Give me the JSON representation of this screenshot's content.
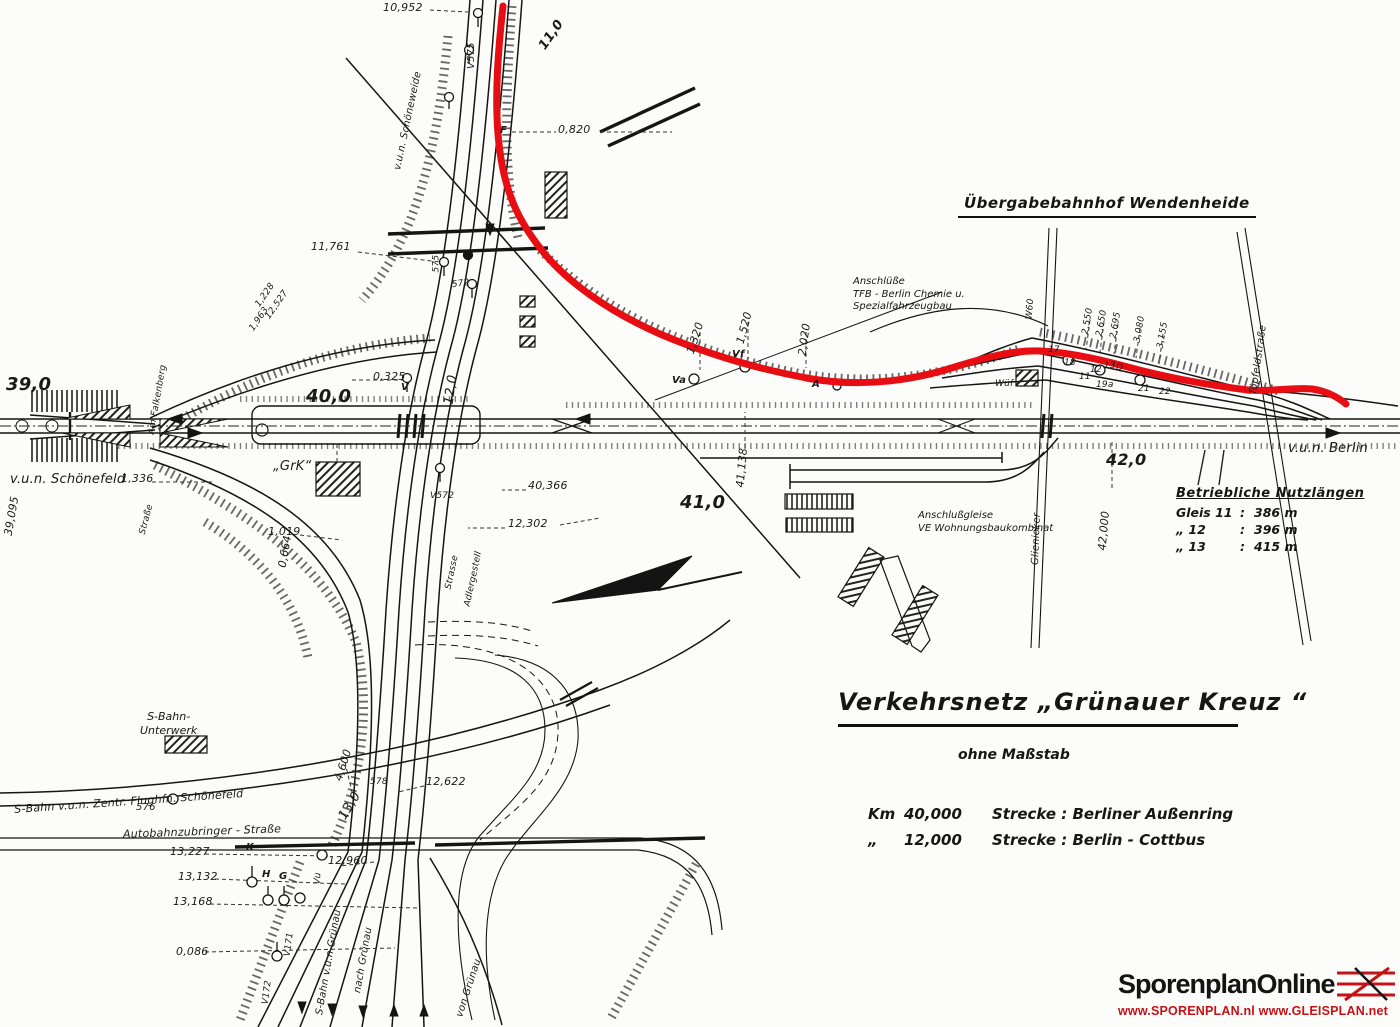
{
  "colors": {
    "ink": "#1a1a1a",
    "route_red": "#e70d12",
    "logo_red": "#c41217",
    "paper": "#fcfcfa"
  },
  "header": {
    "station": "Übergabebahnhof  Wendenheide"
  },
  "title_block": {
    "title": "Verkehrsnetz  „Grünauer  Kreuz “",
    "subtitle": "ohne Maßstab",
    "rows": [
      {
        "c1": "Km",
        "c2": "40,000",
        "c3": "Strecke :  Berliner Außenring"
      },
      {
        "c1": "„",
        "c2": "12,000",
        "c3": "Strecke :  Berlin - Cottbus"
      }
    ]
  },
  "nutzlaengen": {
    "heading": "Betriebliche Nutzlängen",
    "rows": [
      {
        "gleis": "Gleis 11",
        "colon": ":",
        "len": "386 m"
      },
      {
        "gleis": "„      12",
        "colon": ":",
        "len": "396 m"
      },
      {
        "gleis": "„      13",
        "colon": ":",
        "len": "415 m"
      }
    ]
  },
  "logo": {
    "name": "SporenplanOnline",
    "urls": "www.SPORENPLAN.nl   www.GLEISPLAN.net"
  },
  "labels": {
    "km_10_952": "10,952",
    "v575": "V575",
    "km_11_0": "11,0",
    "schoeneweide": "v.u.n. Schöneweide",
    "km_0_820": "0,820",
    "sig_f": "F",
    "km_11_761": "11,761",
    "sig_575": "575",
    "sig_572": "572",
    "km_1_228": "1,228",
    "km_12_527": "12,527",
    "km_1_963": "1,963",
    "km_0_325": "0,325",
    "sig_v": "V",
    "km_12_0": "12,0",
    "km_40_0": "40,0",
    "km_39_0": "39,0",
    "schoenefeld": "v.u.n. Schönefeld",
    "km_1_336": "1,336",
    "km_39_095": "39,095",
    "am_falkenberg": "Am Falkenberg",
    "strasse_left": "Straße",
    "grk": "„GrK“",
    "km_1_019": "1,019",
    "km_0_664": "0,664",
    "v572": "V572",
    "km_12_302": "12,302",
    "km_40_366": "40,366",
    "strasse_mid": "Strasse",
    "adlergestell": "Adlergestell",
    "km_1_320": "1,320",
    "km_1_520": "1,520",
    "km_2_020": "2,020",
    "sig_va": "Va",
    "sig_vf": "Vf",
    "sig_a": "A",
    "chemie_1": "Anschlüße",
    "chemie_2": "TFB - Berlin Chemie u.",
    "chemie_3": "Spezialfahrzeugbau",
    "w60": "W60",
    "km_2_550": "2,550",
    "km_2_650": "2,650",
    "km_2_695": "2,695",
    "km_3_080": "3,080",
    "km_3_155": "3,155",
    "n17": "17",
    "n18": "18",
    "n12": "12",
    "n13": "13",
    "nd": "D",
    "n19a": "19a",
    "n21": "21",
    "n22": "22",
    "n11": "11",
    "wuef": "Wüf",
    "km_41_138": "41,138",
    "km_41_0": "41,0",
    "wbk_1": "Anschlußgleise",
    "wbk_2": "VE Wohnungsbaukombinat",
    "glienicker": "Glienicker",
    "km_42_0": "42,0",
    "km_42_000": "42,000",
    "toepfeldstrasse": "Töpfeldstraße",
    "vun_berlin": "v.u.n. Berlin",
    "unterwerk_1": "S-Bahn-",
    "unterwerk_2": "Unterwerk",
    "km_4_600": "4,600",
    "sbahn_schoenefeld": "S-Bahn v.u.n. Zentr. Flughfn. Schönefeld",
    "sig_576": "576",
    "autobahnzubringer": "Autobahnzubringer - Straße",
    "km_13_227": "13,227",
    "km_13_132": "13,132",
    "km_13_168": "13,168",
    "km_0_086": "0,086",
    "km_12_960": "12,960",
    "km_12_622": "12,622",
    "km_13_0": "13,0",
    "sig_578": "578",
    "sig_k": "K",
    "sig_h": "H",
    "sig_g": "G",
    "sig_vu": "Vu",
    "v171": "V171",
    "v172": "V172",
    "sbahn_gruenau": "S-Bahn v.u.n Grünau",
    "nach_gruenau": "nach Grünau",
    "von_gruenau": "von Grünau"
  }
}
